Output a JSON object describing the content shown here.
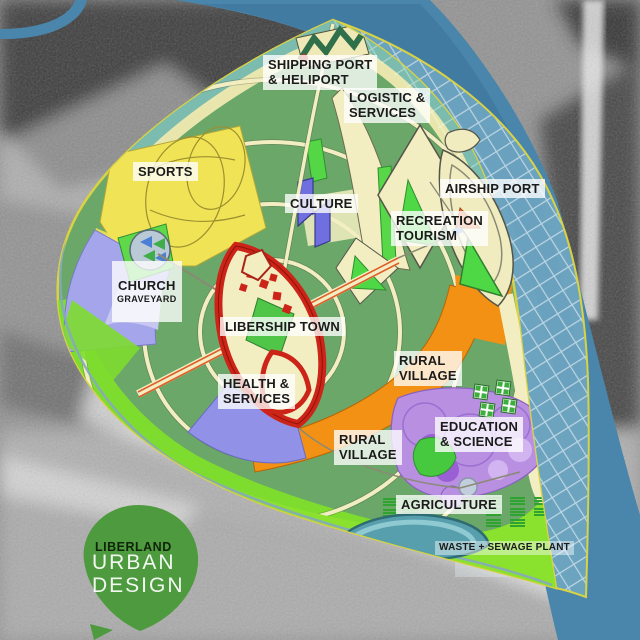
{
  "map": {
    "zones": [
      {
        "id": "shipping",
        "text": "SHIPPING PORT\n& HELIPORT"
      },
      {
        "id": "logistic",
        "text": "LOGISTIC &\nSERVICES"
      },
      {
        "id": "sports",
        "text": "SPORTS"
      },
      {
        "id": "culture",
        "text": "CULTURE"
      },
      {
        "id": "airship",
        "text": "AIRSHIP PORT"
      },
      {
        "id": "recreation",
        "text": "RECREATION\nTOURISM"
      },
      {
        "id": "church",
        "text": "CHURCH",
        "sub": "GRAVEYARD"
      },
      {
        "id": "libership",
        "text": "LIBERSHIP TOWN"
      },
      {
        "id": "health",
        "text": "HEALTH &\nSERVICES"
      },
      {
        "id": "rural-village-east",
        "text": "RURAL\nVILLAGE"
      },
      {
        "id": "education",
        "text": "EDUCATION\n& SCIENCE"
      },
      {
        "id": "rural-village-south",
        "text": "RURAL\nVILLAGE"
      },
      {
        "id": "agriculture",
        "text": "AGRICULTURE"
      },
      {
        "id": "waste",
        "text": "WASTE + SEWAGE PLANT"
      }
    ],
    "colors": {
      "zone_green": "#6ba769",
      "zone_lime": "#7edc2f",
      "zone_agriculture": "#8ae12e",
      "zone_yellow": "#f0e356",
      "zone_cream": "#f2eec2",
      "zone_teal_band": "#7cbcae",
      "zone_lavender": "#a5a5ec",
      "zone_red": "#cc2418",
      "zone_orange": "#f29113",
      "zone_purple": "#b98fe2",
      "river_blue": "#4a86ab",
      "claim_line": "#d9d243",
      "pond_teal": "#579fad",
      "label_text": "#1b1b1b"
    }
  },
  "logo": {
    "brand": "LIBERLAND",
    "line1": "URBAN",
    "line2": "DESIGN"
  }
}
